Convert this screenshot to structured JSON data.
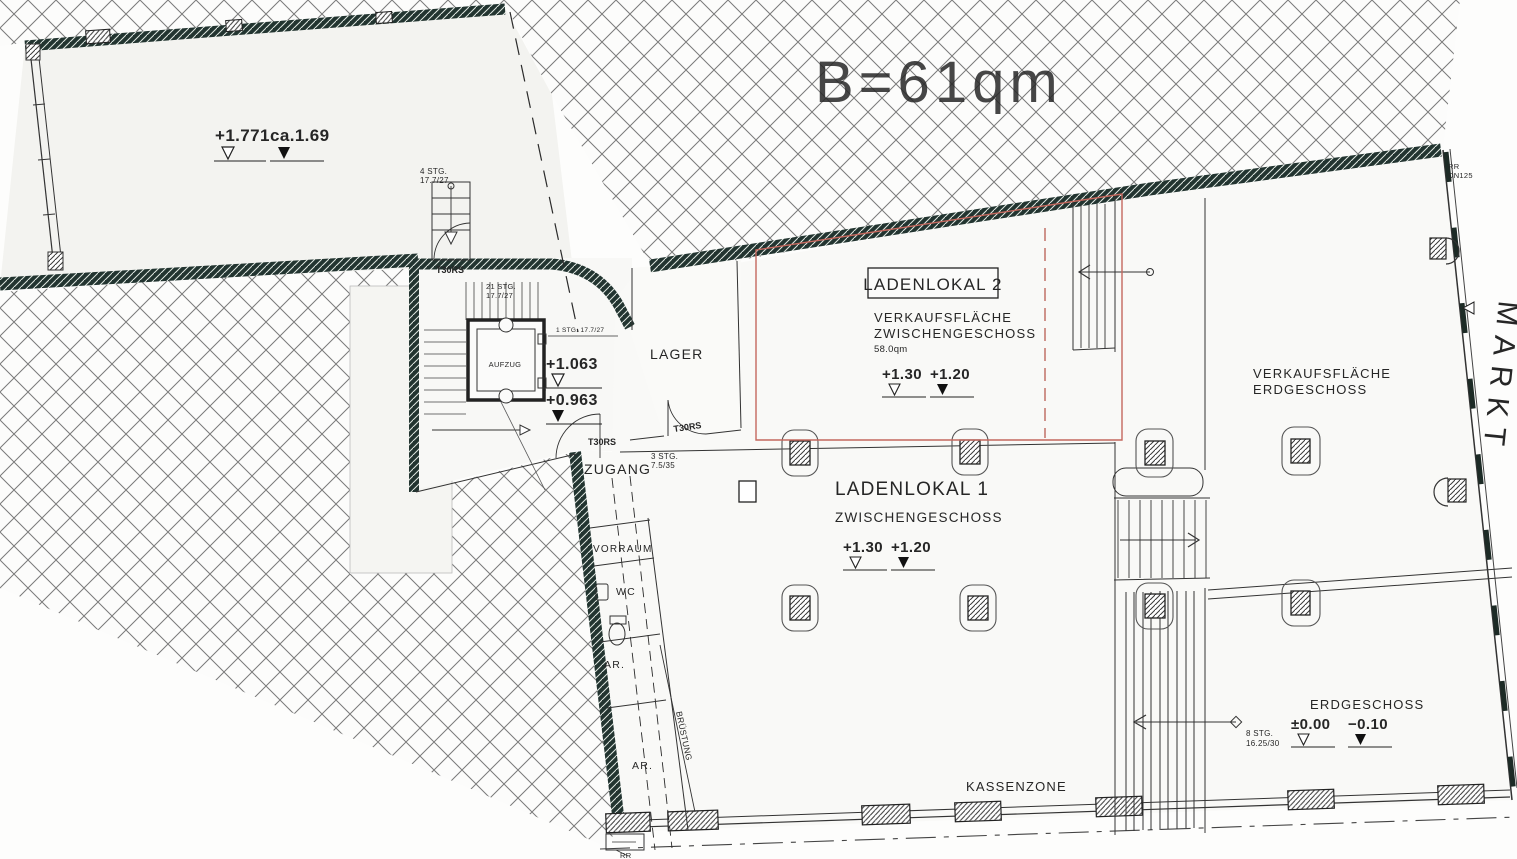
{
  "colors": {
    "red_accent": "#c4685e",
    "red_text": "#cf7d71",
    "wall_dark": "#223430",
    "hatch_gray": "#7a7a7a",
    "paper": "#fdfdfc"
  },
  "annotations": {
    "area_note": "B=61qm",
    "street": "MARKT",
    "rr": "RR",
    "dn": "DN125",
    "bruestung": "BRÜSTUNG"
  },
  "rooms": {
    "upper": {
      "lvl_open": "+1.771",
      "lvl_filled": "ca.1.69"
    },
    "mid_landing": {
      "lvl_open": "+1.063",
      "lvl_filled": "+0.963"
    },
    "lager": "LAGER",
    "zugang": "ZUGANG",
    "vorraum": "VORRAUM",
    "wc": "WC",
    "ar": "AR.",
    "aufzug": "AUFZUG",
    "ladenlokal2": {
      "title": "LADENLOKAL 2",
      "sub1": "VERKAUFSFLÄCHE",
      "sub2": "ZWISCHENGESCHOSS",
      "area": "58.0qm",
      "lvl_open": "+1.30",
      "lvl_filled": "+1.20"
    },
    "ladenlokal1": {
      "title": "LADENLOKAL 1",
      "sub1": "ZWISCHENGESCHOSS",
      "lvl_open": "+1.30",
      "lvl_filled": "+1.20"
    },
    "verkauf_eg": {
      "sub1": "VERKAUFSFLÄCHE",
      "sub2": "ERDGESCHOSS"
    },
    "eg": {
      "title": "ERDGESCHOSS",
      "lvl_open": "±0.00",
      "lvl_filled": "−0.10"
    },
    "kassenzone": "KASSENZONE"
  },
  "stairs": {
    "s4a": "4 STG.",
    "s4b": "17.7/27",
    "s21a": "21 STG.",
    "s21b": "17.7/27",
    "s1": "1 STG.  17.7/27",
    "s3a": "3 STG.",
    "s3b": "7.5/35",
    "s8a": "8 STG.",
    "s8b": "16.25/30"
  },
  "doors": {
    "t30rs": "T30RS"
  }
}
